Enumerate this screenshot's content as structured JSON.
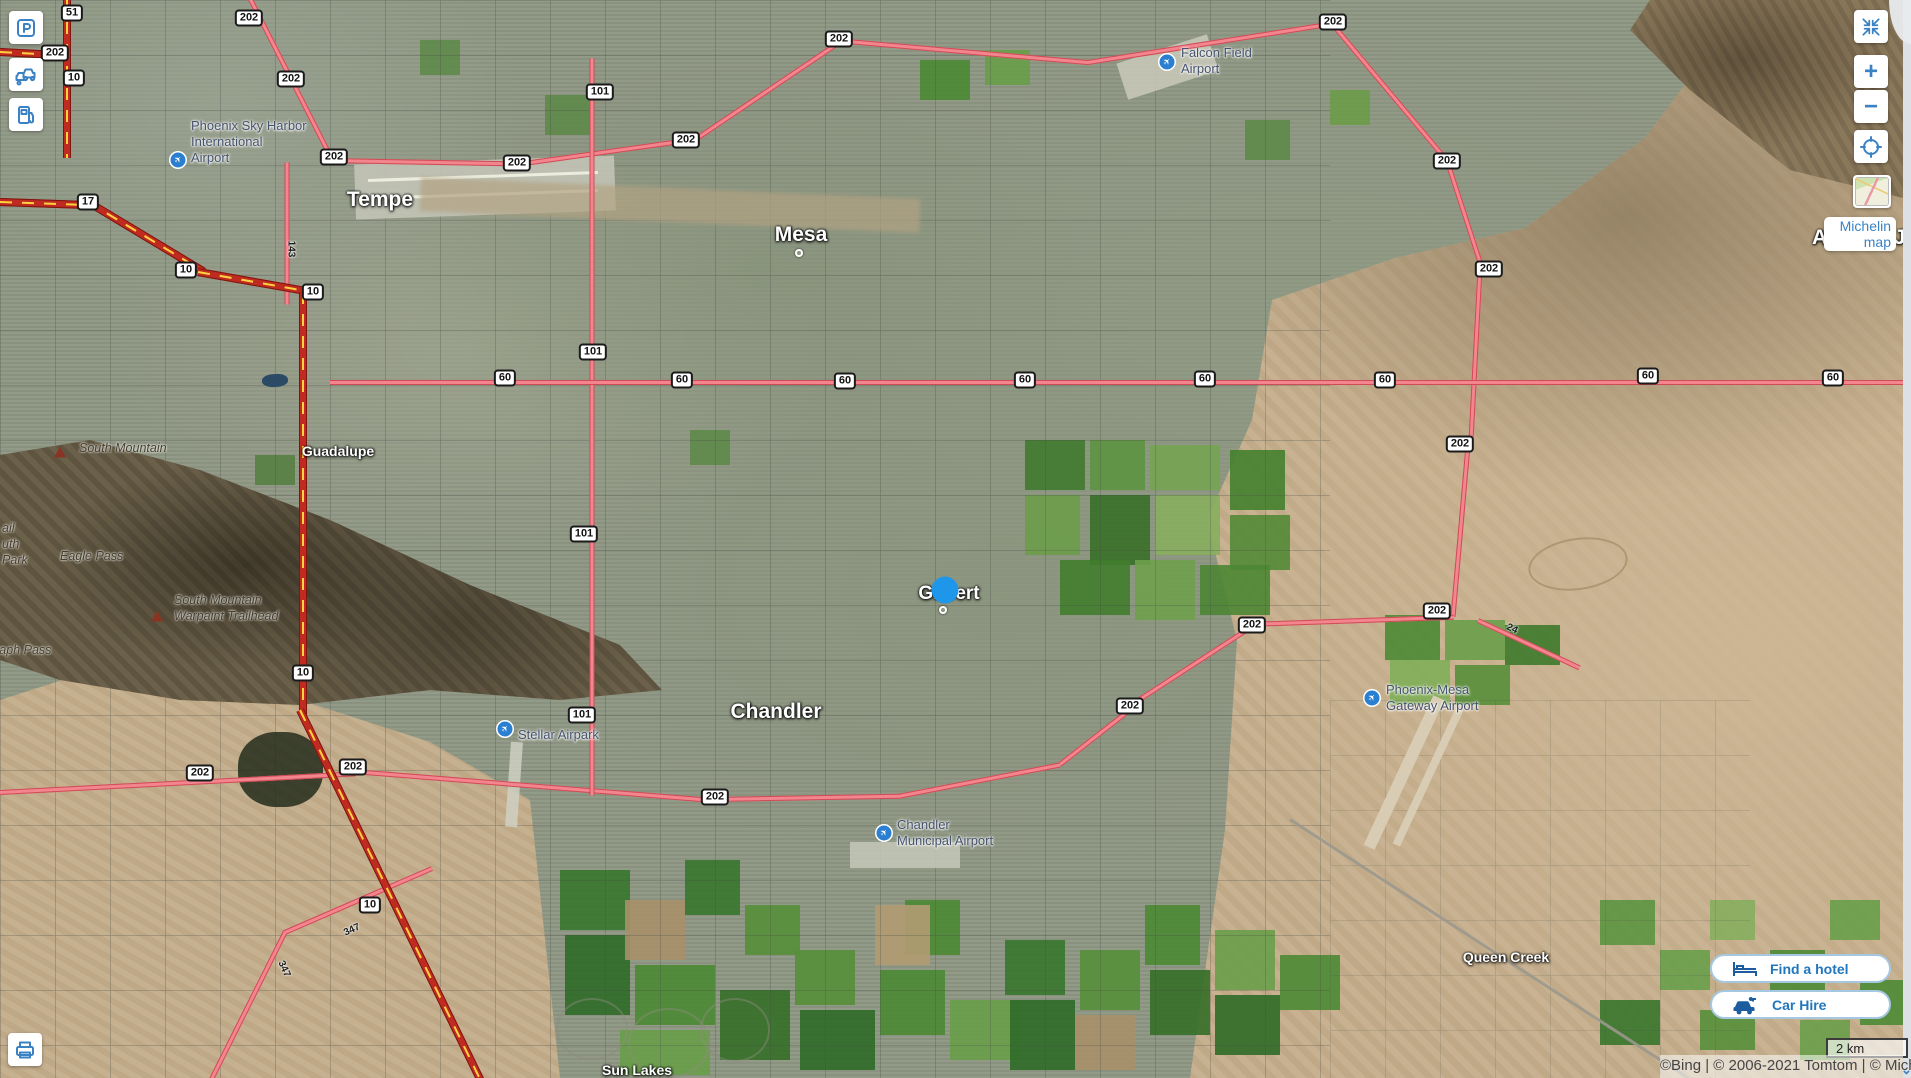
{
  "attribution": {
    "text": "©Bing | © 2006-2021 Tomtom | © Michelin",
    "expander_glyph": "⌄"
  },
  "scale": {
    "label": "2 km"
  },
  "controls": {
    "zoom_in_glyph": "+",
    "zoom_out_glyph": "−",
    "map_style_tooltip": "Michelin map",
    "hotel_button": "Find a hotel",
    "car_button": "Car Hire"
  },
  "map": {
    "cities": [
      {
        "name": "Tempe",
        "x": 380,
        "y": 200,
        "size": "lg"
      },
      {
        "name": "Mesa",
        "x": 801,
        "y": 235,
        "size": "lg"
      },
      {
        "name": "Chandler",
        "x": 776,
        "y": 712,
        "size": "lg"
      },
      {
        "name": "Gilbert",
        "x": 949,
        "y": 594,
        "size": "md"
      },
      {
        "name": "Apache Junction",
        "x": 1812,
        "y": 238,
        "size": "lg",
        "align": "left"
      },
      {
        "name": "Guadalupe",
        "x": 338,
        "y": 451,
        "size": "sm"
      },
      {
        "name": "Queen Creek",
        "x": 1506,
        "y": 957,
        "size": "sm"
      },
      {
        "name": "Sun Lakes",
        "x": 637,
        "y": 1070,
        "size": "sm"
      }
    ],
    "airports": [
      {
        "id": "phoenix-sky-harbor",
        "icon_x": 178,
        "icon_y": 160,
        "text_x": 191,
        "text_y": 118,
        "lines": [
          "Phoenix Sky Harbor",
          "International",
          "Airport"
        ]
      },
      {
        "id": "falcon-field",
        "icon_x": 1167,
        "icon_y": 62,
        "text_x": 1181,
        "text_y": 45,
        "lines": [
          "Falcon Field",
          "Airport"
        ]
      },
      {
        "id": "stellar-airpark",
        "icon_x": 505,
        "icon_y": 729,
        "text_x": 518,
        "text_y": 727,
        "lines": [
          "Stellar Airpark"
        ]
      },
      {
        "id": "chandler-municipal",
        "icon_x": 884,
        "icon_y": 833,
        "text_x": 897,
        "text_y": 817,
        "lines": [
          "Chandler",
          "Municipal Airport"
        ]
      },
      {
        "id": "phoenix-mesa-gateway",
        "icon_x": 1372,
        "icon_y": 698,
        "text_x": 1386,
        "text_y": 682,
        "lines": [
          "Phoenix-Mesa",
          "Gateway Airport"
        ]
      }
    ],
    "pois": [
      {
        "lines": [
          "South Mountain"
        ],
        "x": 79,
        "y": 440,
        "peak_x": 60,
        "peak_y": 452
      },
      {
        "lines": [
          "Eagle Pass"
        ],
        "x": 60,
        "y": 548
      },
      {
        "lines": [
          "South Mountain",
          "Warpaint Trailhead"
        ],
        "x": 174,
        "y": 592,
        "peak_x": 157,
        "peak_y": 616
      },
      {
        "lines": [
          "Telegraph Pass"
        ],
        "x": -35,
        "y": 642
      },
      {
        "lines": [
          "ail",
          "uth",
          "Park"
        ],
        "x": 2,
        "y": 520
      }
    ],
    "shields": [
      {
        "label": "51",
        "x": 72,
        "y": 13
      },
      {
        "label": "202",
        "x": 55,
        "y": 53
      },
      {
        "label": "10",
        "x": 74,
        "y": 78
      },
      {
        "label": "202",
        "x": 249,
        "y": 18
      },
      {
        "label": "202",
        "x": 291,
        "y": 79
      },
      {
        "label": "202",
        "x": 334,
        "y": 157
      },
      {
        "label": "17",
        "x": 88,
        "y": 202
      },
      {
        "label": "10",
        "x": 186,
        "y": 270
      },
      {
        "label": "10",
        "x": 313,
        "y": 292
      },
      {
        "label": "101",
        "x": 600,
        "y": 92
      },
      {
        "label": "202",
        "x": 517,
        "y": 163
      },
      {
        "label": "202",
        "x": 686,
        "y": 140
      },
      {
        "label": "202",
        "x": 839,
        "y": 39
      },
      {
        "label": "202",
        "x": 1333,
        "y": 22
      },
      {
        "label": "202",
        "x": 1447,
        "y": 161
      },
      {
        "label": "202",
        "x": 1489,
        "y": 269
      },
      {
        "label": "202",
        "x": 1460,
        "y": 444
      },
      {
        "label": "202",
        "x": 1437,
        "y": 611
      },
      {
        "label": "101",
        "x": 593,
        "y": 352
      },
      {
        "label": "101",
        "x": 584,
        "y": 534
      },
      {
        "label": "101",
        "x": 582,
        "y": 715
      },
      {
        "label": "60",
        "x": 505,
        "y": 378
      },
      {
        "label": "60",
        "x": 682,
        "y": 380
      },
      {
        "label": "60",
        "x": 845,
        "y": 381
      },
      {
        "label": "60",
        "x": 1025,
        "y": 380
      },
      {
        "label": "60",
        "x": 1205,
        "y": 379
      },
      {
        "label": "60",
        "x": 1385,
        "y": 380
      },
      {
        "label": "60",
        "x": 1648,
        "y": 376
      },
      {
        "label": "60",
        "x": 1833,
        "y": 378
      },
      {
        "label": "202",
        "x": 1252,
        "y": 625
      },
      {
        "label": "202",
        "x": 1130,
        "y": 706
      },
      {
        "label": "202",
        "x": 715,
        "y": 797
      },
      {
        "label": "202",
        "x": 353,
        "y": 767
      },
      {
        "label": "202",
        "x": 200,
        "y": 773
      },
      {
        "label": "10",
        "x": 303,
        "y": 673
      },
      {
        "label": "10",
        "x": 370,
        "y": 905
      }
    ],
    "road_labels": [
      {
        "label": "143",
        "x": 291,
        "y": 249,
        "rot": 90
      },
      {
        "label": "347",
        "x": 352,
        "y": 930,
        "rot": -25
      },
      {
        "label": "347",
        "x": 284,
        "y": 969,
        "rot": 65
      },
      {
        "label": "24",
        "x": 1512,
        "y": 629,
        "rot": 25
      }
    ],
    "markers": [
      {
        "type": "ring",
        "x": 799,
        "y": 253,
        "name": "mesa-city-marker"
      },
      {
        "type": "dot",
        "x": 945,
        "y": 590,
        "name": "gilbert-selected-marker"
      },
      {
        "type": "ring",
        "x": 943,
        "y": 610,
        "name": "gilbert-city-marker"
      }
    ]
  }
}
